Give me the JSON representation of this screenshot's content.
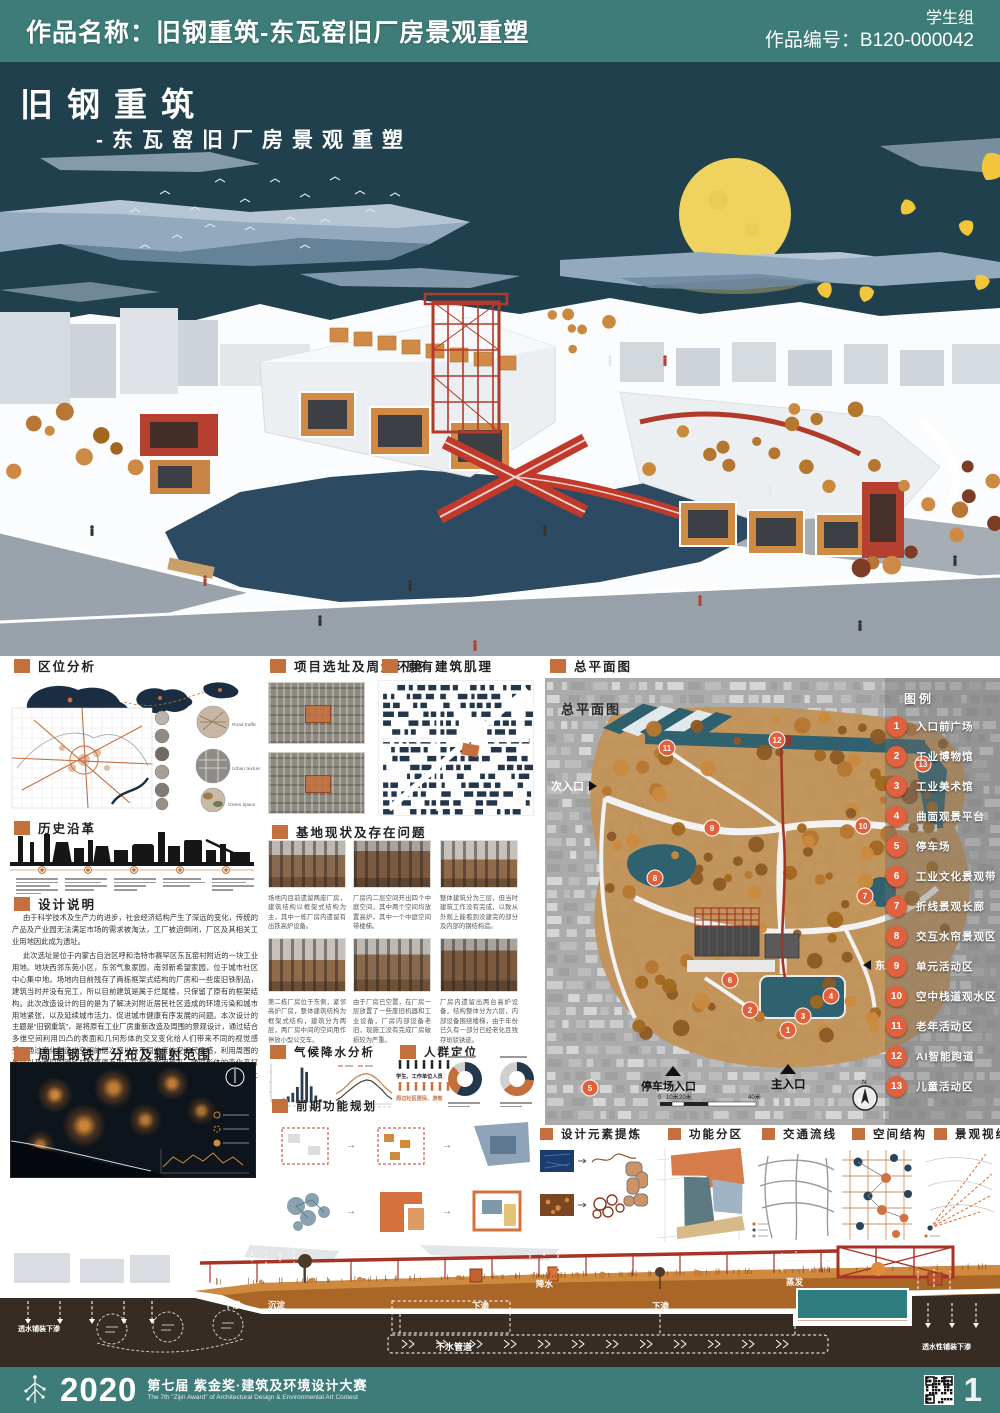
{
  "header": {
    "work_name": "作品名称：旧钢重筑-东瓦窑旧厂房景观重塑",
    "group": "学生组",
    "work_code": "作品编号：B120-000042"
  },
  "hero": {
    "title": "旧钢重筑",
    "subtitle": "-东瓦窑旧厂房景观重塑"
  },
  "left_col": {
    "location": {
      "title": "区位分析",
      "circle_labels": [
        "Road traffic",
        "Urban texture",
        "Green space"
      ]
    },
    "history": {
      "title": "历史沿革"
    },
    "description": {
      "title": "设计说明",
      "paragraphs": [
        "由于科学技术及生产力的进步，社会经济结构产生了深远的变化，传统的产品及产业园无法满足市场的需求被淘汰，工厂被迫倒闭，厂区及其相关工业用地因此成为遗址。",
        "此次选址是位于内蒙古自治区呼和浩特市赛罕区东瓦窑村附近的一块工业用地。地块西邻东苑小区，东邻气象家园，南邻新希望家园，位于城市社区中心集中地。场地内目前残存了两栋框架式结构的厂房和一些废旧铁制品，建筑当时并没有完工，所以目前建筑是属于烂尾楼，只保留了原有的框架结构。此次改造设计的目的是为了解决对附近居民社区造成的环境污染和城市用地紧张，以及延续城市活力、促进城市健康有序发展的问题。本次设计的主题是“旧钢重筑”，是将原有工业厂房重新改造及周围的景观设计，通过结合多维空间利用凹凸的表面和几何形体的交叉变化给人们带来不同的视觉感受，通过变化制造出空间的层次感以及不同维度的空间尺度感，利用周围的景观以及废旧的钢铁材料将原有的厂房重新利用起来，通过形体的变化来打破原有的三维空间给人们带来多样的空间感受。在保留原有工业痕迹基础上与厂房进行呼应，赋予厂区新生命，为城市的健康发展注入新的活力。"
      ]
    },
    "radiation": {
      "title": "周围钢铁厂分布及辐射范围"
    }
  },
  "mid_col": {
    "site": {
      "title": "项目选址及周边环境"
    },
    "texture": {
      "title": "原有建筑肌理"
    },
    "status": {
      "title": "基地现状及存在问题",
      "captions": [
        "场地内目前遗留两座厂房，建筑结构以框架式结构为主，其中一栋厂房内遗留有出铁高炉设备。",
        "厂房内二层空间开出四个中庭空间，其中两个空间均放置高炉，其中一个中庭空间带楼梯。",
        "整体建筑分为三层，但当时建筑工作没有完成，以致从外观上能看到没建完的部分及内部的钢结构造。",
        "第二栋厂房位于东侧，紧邻高炉厂房，整体建筑结构为框架式结构，建筑分为两层，两厂房中间的空间用作停放小型公交车。",
        "由于厂房已空置，在厂房一层放置了一些废旧机器和工业设备，厂房内部设备老旧，现施工没有完成厂房破损较为严重。",
        "厂房内遗留出两台高炉设备，结构整体分为六层，内部设备围绕楼梯，由于年份已久有一部分已经老化且残存斑驳锈迹。"
      ]
    },
    "climate": {
      "title": "气候降水分析"
    },
    "crowd": {
      "title": "人群定位",
      "group1": "学生、工作单位人员",
      "group2": "周边社区居民、游客"
    },
    "planning": {
      "title": "前期功能规划"
    }
  },
  "right_col": {
    "masterplan": {
      "title": "总平面图",
      "overlay_title": "总平面图",
      "legend_title": "图例",
      "entrance_secondary": "次入口",
      "entrance_east": "东入口",
      "entrance_parking": "停车场入口",
      "entrance_main": "主入口",
      "scale_0": "0",
      "scale_10": "10米",
      "scale_20": "20米",
      "scale_40": "40米",
      "north": "N",
      "legend": [
        {
          "num": "1",
          "label": "入口前广场"
        },
        {
          "num": "2",
          "label": "工业博物馆"
        },
        {
          "num": "3",
          "label": "工业美术馆"
        },
        {
          "num": "4",
          "label": "曲面观景平台"
        },
        {
          "num": "5",
          "label": "停车场"
        },
        {
          "num": "6",
          "label": "工业文化景观带"
        },
        {
          "num": "7",
          "label": "折线景观长廊"
        },
        {
          "num": "8",
          "label": "交互水帘景观区"
        },
        {
          "num": "9",
          "label": "单元活动区"
        },
        {
          "num": "10",
          "label": "空中栈道观水区"
        },
        {
          "num": "11",
          "label": "老年活动区"
        },
        {
          "num": "12",
          "label": "AI智能跑道"
        },
        {
          "num": "13",
          "label": "儿童活动区"
        }
      ]
    },
    "bottom_sections": [
      {
        "title": "设计元素提炼"
      },
      {
        "title": "功能分区"
      },
      {
        "title": "交通流线"
      },
      {
        "title": "空间结构"
      },
      {
        "title": "景观视线"
      }
    ]
  },
  "section_view": {
    "rain": "降水",
    "evaporation": "蒸发",
    "sediment": "沉淀",
    "infiltration": "下渗",
    "pipe": "下水管道",
    "permeable_left": "透水铺装下渗",
    "permeable_right": "透水性铺装下渗"
  },
  "footer": {
    "year": "2020",
    "award_line": "第七届 紫金奖·建筑及环境设计大赛",
    "award_en": "The 7th \"Zijin Award\" of Architectural Design & Environmental Art Contest",
    "page": "1"
  },
  "chart_data": [
    {
      "type": "bar",
      "title": "月降水量(毫米)",
      "categories": [
        "1",
        "2",
        "3",
        "4",
        "5",
        "6",
        "7",
        "8",
        "9",
        "10",
        "11",
        "12"
      ],
      "values": [
        3,
        5,
        10,
        17,
        28,
        46,
        105,
        92,
        48,
        20,
        8,
        4
      ],
      "ylim": [
        0,
        110
      ]
    },
    {
      "type": "line",
      "title": "月气温(摄氏度)",
      "x": [
        "1",
        "2",
        "3",
        "4",
        "5",
        "6",
        "7",
        "8",
        "9",
        "10",
        "11",
        "12"
      ],
      "series": [
        {
          "name": "高温",
          "color": "#c87a45",
          "values": [
            -6,
            -1,
            7,
            16,
            23,
            27,
            29,
            26,
            20,
            11,
            2,
            -5
          ]
        },
        {
          "name": "低温",
          "color": "#444444",
          "values": [
            -17,
            -12,
            -4,
            3,
            10,
            15,
            18,
            16,
            9,
            1,
            -9,
            -15
          ]
        }
      ],
      "ylim": [
        -20,
        35
      ]
    },
    {
      "type": "donut",
      "title": "人群构成",
      "donuts": [
        {
          "segments": [
            {
              "color": "#23384a",
              "pct": 58
            },
            {
              "color": "#c4703c",
              "pct": 30
            },
            {
              "color": "#cfcfcf",
              "pct": 12
            }
          ]
        },
        {
          "segments": [
            {
              "color": "#23384a",
              "pct": 26
            },
            {
              "color": "#c4703c",
              "pct": 38
            },
            {
              "color": "#cfcfcf",
              "pct": 36
            }
          ]
        }
      ]
    }
  ],
  "colors": {
    "teal_band": "#3d7c78",
    "sky": "#21404d",
    "accent_orange": "#c4703c",
    "legend_orange": "#e2603c",
    "structure_red": "#a93226",
    "water_navy": "#2c4b63",
    "plan_water": "#30616f",
    "moon": "#efd35e",
    "ginkgo": "#f2c53d"
  }
}
